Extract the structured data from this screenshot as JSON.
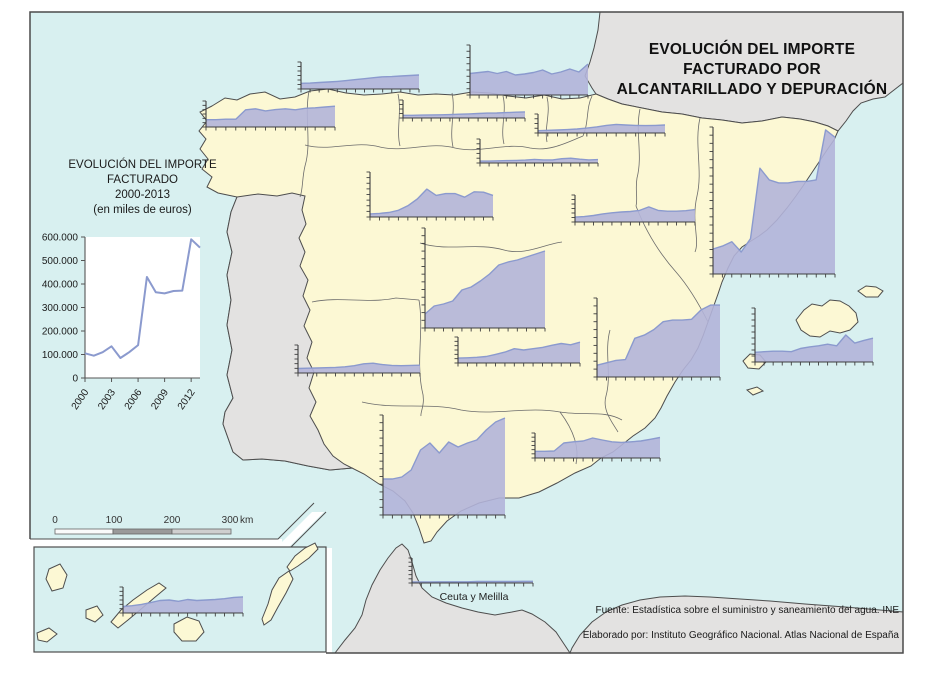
{
  "map_title": {
    "lines": [
      "EVOLUCIÓN DEL IMPORTE",
      "FACTURADO POR",
      "ALCANTARILLADO Y DEPURACIÓN"
    ]
  },
  "legend": {
    "title_lines": [
      "EVOLUCIÓN DEL IMPORTE",
      "FACTURADO",
      "2000-2013",
      "(en miles de euros)"
    ]
  },
  "scalebar": {
    "tick_labels": [
      "0",
      "100",
      "200",
      "300"
    ],
    "unit": "km"
  },
  "annotations": {
    "ceuta_melilla_label": "Ceuta y Melilla"
  },
  "credits": {
    "source": "Fuente: Estadística sobre el suministro y saneamiento del agua. INE",
    "elaboration": "Elaborado por: Instituto Geográfico Nacional. Atlas Nacional de España"
  },
  "colors": {
    "sea": "#d8f0f0",
    "spain_land": "#fcf8d4",
    "other_land": "#e3e2e1",
    "coast_stroke": "#4d4d4d",
    "region_border": "#6b6b6b",
    "chart_fill": "#b2b4d9",
    "chart_line": "#8b9ace",
    "axis": "#3f3f3f"
  },
  "chart_data": {
    "legend_chart": {
      "type": "line",
      "title": "EVOLUCIÓN DEL IMPORTE FACTURADO 2000-2013 (en miles de euros)",
      "x": [
        2000,
        2001,
        2002,
        2003,
        2004,
        2005,
        2006,
        2007,
        2008,
        2009,
        2010,
        2011,
        2012,
        2013
      ],
      "values": [
        105000,
        95000,
        110000,
        135000,
        85000,
        110000,
        140000,
        430000,
        365000,
        360000,
        370000,
        372000,
        590000,
        555000
      ],
      "ylim": [
        0,
        600000
      ],
      "y_tick_labels": [
        "600.000",
        "500.000",
        "400.000",
        "300.000",
        "200.000",
        "100.000",
        "0"
      ],
      "x_tick_labels": [
        "2000",
        "2003",
        "2006",
        "2009",
        "2012"
      ],
      "grid": false,
      "legend_position": "none"
    },
    "mini_charts": {
      "type": "area",
      "note": "one area chart per autonomous community; series normalized 0-1 of each chart's own axis; x = years 2000-2013",
      "x": [
        2000,
        2001,
        2002,
        2003,
        2004,
        2005,
        2006,
        2007,
        2008,
        2009,
        2010,
        2011,
        2012,
        2013
      ],
      "regions": [
        {
          "id": "galicia",
          "box": [
            206,
            101,
            129,
            26
          ],
          "series": [
            0.28,
            0.28,
            0.3,
            0.3,
            0.66,
            0.7,
            0.62,
            0.67,
            0.7,
            0.66,
            0.72,
            0.74,
            0.77,
            0.8
          ]
        },
        {
          "id": "asturias",
          "box": [
            301,
            62,
            118,
            27
          ],
          "series": [
            0.21,
            0.22,
            0.24,
            0.26,
            0.28,
            0.31,
            0.35,
            0.38,
            0.42,
            0.45,
            0.46,
            0.48,
            0.5,
            0.52
          ]
        },
        {
          "id": "pais-vasco",
          "box": [
            470,
            45,
            118,
            50
          ],
          "series": [
            0.43,
            0.45,
            0.47,
            0.43,
            0.47,
            0.4,
            0.42,
            0.45,
            0.5,
            0.42,
            0.46,
            0.52,
            0.46,
            0.62
          ]
        },
        {
          "id": "cantabria",
          "box": [
            403,
            100,
            122,
            18
          ],
          "series": [
            0.15,
            0.15,
            0.16,
            0.17,
            0.18,
            0.19,
            0.21,
            0.23,
            0.25,
            0.27,
            0.28,
            0.3,
            0.32,
            0.34
          ]
        },
        {
          "id": "navarra",
          "box": [
            538,
            114,
            127,
            19
          ],
          "series": [
            0.12,
            0.14,
            0.16,
            0.18,
            0.21,
            0.26,
            0.32,
            0.4,
            0.45,
            0.42,
            0.4,
            0.39,
            0.4,
            0.42
          ]
        },
        {
          "id": "la-rioja",
          "box": [
            480,
            139,
            118,
            24
          ],
          "series": [
            0.08,
            0.08,
            0.09,
            0.1,
            0.11,
            0.12,
            0.15,
            0.13,
            0.13,
            0.18,
            0.2,
            0.16,
            0.13,
            0.14
          ]
        },
        {
          "id": "castilla-y-leon",
          "box": [
            370,
            172,
            123,
            45
          ],
          "series": [
            0.07,
            0.08,
            0.1,
            0.15,
            0.25,
            0.4,
            0.62,
            0.48,
            0.52,
            0.52,
            0.44,
            0.56,
            0.55,
            0.48
          ]
        },
        {
          "id": "aragon",
          "box": [
            575,
            195,
            120,
            27
          ],
          "series": [
            0.18,
            0.2,
            0.24,
            0.3,
            0.34,
            0.37,
            0.39,
            0.43,
            0.56,
            0.43,
            0.4,
            0.4,
            0.42,
            0.46
          ]
        },
        {
          "id": "cataluna",
          "box": [
            713,
            127,
            122,
            147
          ],
          "series": [
            0.17,
            0.19,
            0.22,
            0.15,
            0.24,
            0.72,
            0.64,
            0.62,
            0.62,
            0.63,
            0.63,
            0.64,
            0.98,
            0.93
          ]
        },
        {
          "id": "madrid",
          "box": [
            425,
            228,
            120,
            100
          ],
          "series": [
            0.14,
            0.22,
            0.24,
            0.27,
            0.38,
            0.41,
            0.47,
            0.54,
            0.63,
            0.66,
            0.68,
            0.71,
            0.74,
            0.77
          ]
        },
        {
          "id": "extremadura",
          "box": [
            298,
            345,
            122,
            28
          ],
          "series": [
            0.16,
            0.17,
            0.18,
            0.19,
            0.2,
            0.22,
            0.26,
            0.33,
            0.35,
            0.3,
            0.27,
            0.26,
            0.27,
            0.28
          ]
        },
        {
          "id": "castilla-la-mancha",
          "box": [
            458,
            337,
            122,
            26
          ],
          "series": [
            0.19,
            0.2,
            0.22,
            0.25,
            0.33,
            0.42,
            0.55,
            0.5,
            0.55,
            0.6,
            0.68,
            0.75,
            0.7,
            0.8
          ]
        },
        {
          "id": "c-valenciana",
          "box": [
            597,
            298,
            123,
            79
          ],
          "series": [
            0.15,
            0.18,
            0.21,
            0.22,
            0.49,
            0.53,
            0.6,
            0.7,
            0.72,
            0.72,
            0.73,
            0.85,
            0.91,
            0.91
          ]
        },
        {
          "id": "illes-balears",
          "box": [
            755,
            308,
            118,
            54
          ],
          "series": [
            0.18,
            0.19,
            0.2,
            0.2,
            0.19,
            0.25,
            0.28,
            0.3,
            0.33,
            0.3,
            0.5,
            0.35,
            0.4,
            0.44
          ]
        },
        {
          "id": "murcia",
          "box": [
            535,
            433,
            125,
            25
          ],
          "series": [
            0.27,
            0.27,
            0.28,
            0.6,
            0.65,
            0.68,
            0.8,
            0.72,
            0.65,
            0.62,
            0.65,
            0.68,
            0.75,
            0.82
          ]
        },
        {
          "id": "andalucia",
          "box": [
            383,
            415,
            122,
            100
          ],
          "series": [
            0.36,
            0.36,
            0.38,
            0.45,
            0.65,
            0.72,
            0.62,
            0.73,
            0.68,
            0.72,
            0.75,
            0.85,
            0.93,
            0.97
          ]
        },
        {
          "id": "canarias",
          "box": [
            123,
            587,
            120,
            26
          ],
          "series": [
            0.25,
            0.28,
            0.33,
            0.4,
            0.48,
            0.5,
            0.45,
            0.52,
            0.48,
            0.5,
            0.52,
            0.55,
            0.6,
            0.62
          ]
        },
        {
          "id": "ceuta-y-melilla",
          "box": [
            412,
            558,
            121,
            25
          ],
          "series": [
            0.04,
            0.04,
            0.04,
            0.05,
            0.05,
            0.05,
            0.05,
            0.06,
            0.06,
            0.06,
            0.06,
            0.06,
            0.07,
            0.07
          ]
        }
      ]
    }
  }
}
